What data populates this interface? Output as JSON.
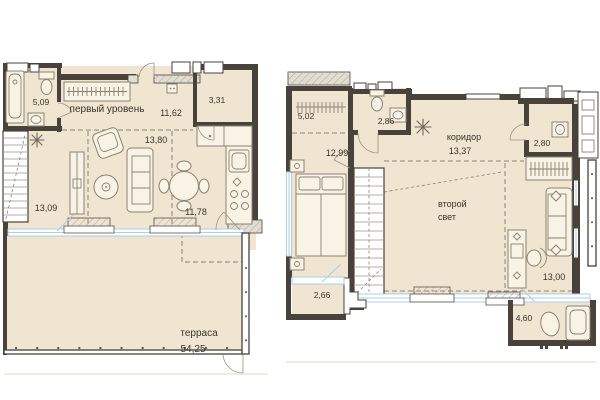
{
  "colors": {
    "wall": "#48423b",
    "wall_hatch_bg": "#e2ddd1",
    "room_fill": "#f0e5d1",
    "window": "#aecde8",
    "furniture_fill": "#f9f3e5",
    "furniture_stroke": "#8b8271",
    "dash": "#8d8678",
    "text": "#39342c",
    "railing": "#5a544c",
    "ground": "#e3dfd5"
  },
  "level1": {
    "title": "первый уровень",
    "rooms": {
      "bathroom": "5,09",
      "hallway": "11,62",
      "wc": "3,31",
      "living": "13,80",
      "room": "13,09",
      "kitchen": "11,78"
    },
    "terrace": {
      "name": "терраса",
      "area": "54,25"
    }
  },
  "level2": {
    "rooms": {
      "wardrobe": "5,02",
      "bathroom": "2,86",
      "bedroom": "12,99",
      "wc": "2,80",
      "cabinet": "13,00"
    },
    "corridor": {
      "name": "коридор",
      "area": "13,37"
    },
    "void": {
      "line1": "второй",
      "line2": "свет"
    },
    "balconies": {
      "small": "2,66",
      "large": "4,60"
    }
  }
}
